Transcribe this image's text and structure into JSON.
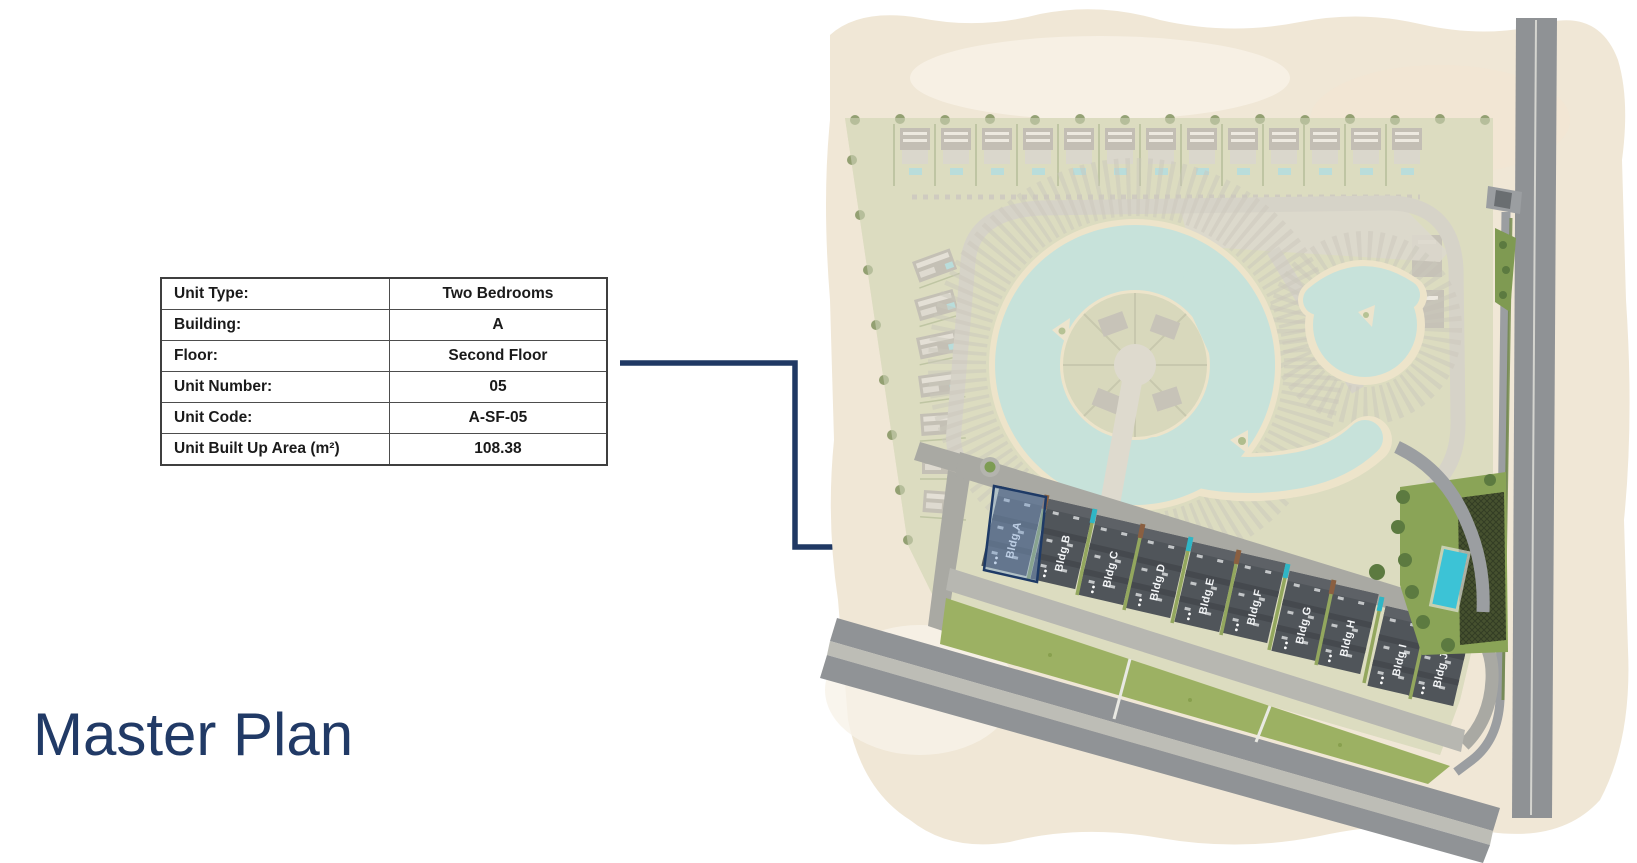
{
  "title": "Master Plan",
  "unit_table": {
    "rows": [
      {
        "label": "Unit Type:",
        "value": "Two Bedrooms"
      },
      {
        "label": "Building:",
        "value": "A"
      },
      {
        "label": "Floor:",
        "value": "Second Floor"
      },
      {
        "label": "Unit Number:",
        "value": "05"
      },
      {
        "label": "Unit Code:",
        "value": "A-SF-05"
      },
      {
        "label": "Unit Built Up Area (m²)",
        "value": "108.38"
      }
    ]
  },
  "map": {
    "buildings": [
      {
        "label": "Bldg A"
      },
      {
        "label": "Bldg B"
      },
      {
        "label": "Bldg C"
      },
      {
        "label": "Bldg D"
      },
      {
        "label": "Bldg E"
      },
      {
        "label": "Bldg F"
      },
      {
        "label": "Bldg G"
      },
      {
        "label": "Bldg H"
      },
      {
        "label": "Bldg I"
      },
      {
        "label": "Bldg J"
      }
    ],
    "highlighted_building": "Bldg A",
    "colors": {
      "accent_navy": "#1f3864",
      "highlight_fill": "#7da0cf",
      "wash_beige": "#f0e7d6",
      "parcel_green": "#cbcfa9",
      "lagoon_water": "#a7d9d6",
      "beach_sand": "#e9dcbb",
      "lawn_green": "#9cb163",
      "park_green": "#8aa457",
      "pool_teal": "#3cc3d6",
      "road_gray": "#97999c",
      "building_gray": "#50555a",
      "teal_accent": "#2fb6c6",
      "brown_accent": "#8a5f41"
    }
  }
}
